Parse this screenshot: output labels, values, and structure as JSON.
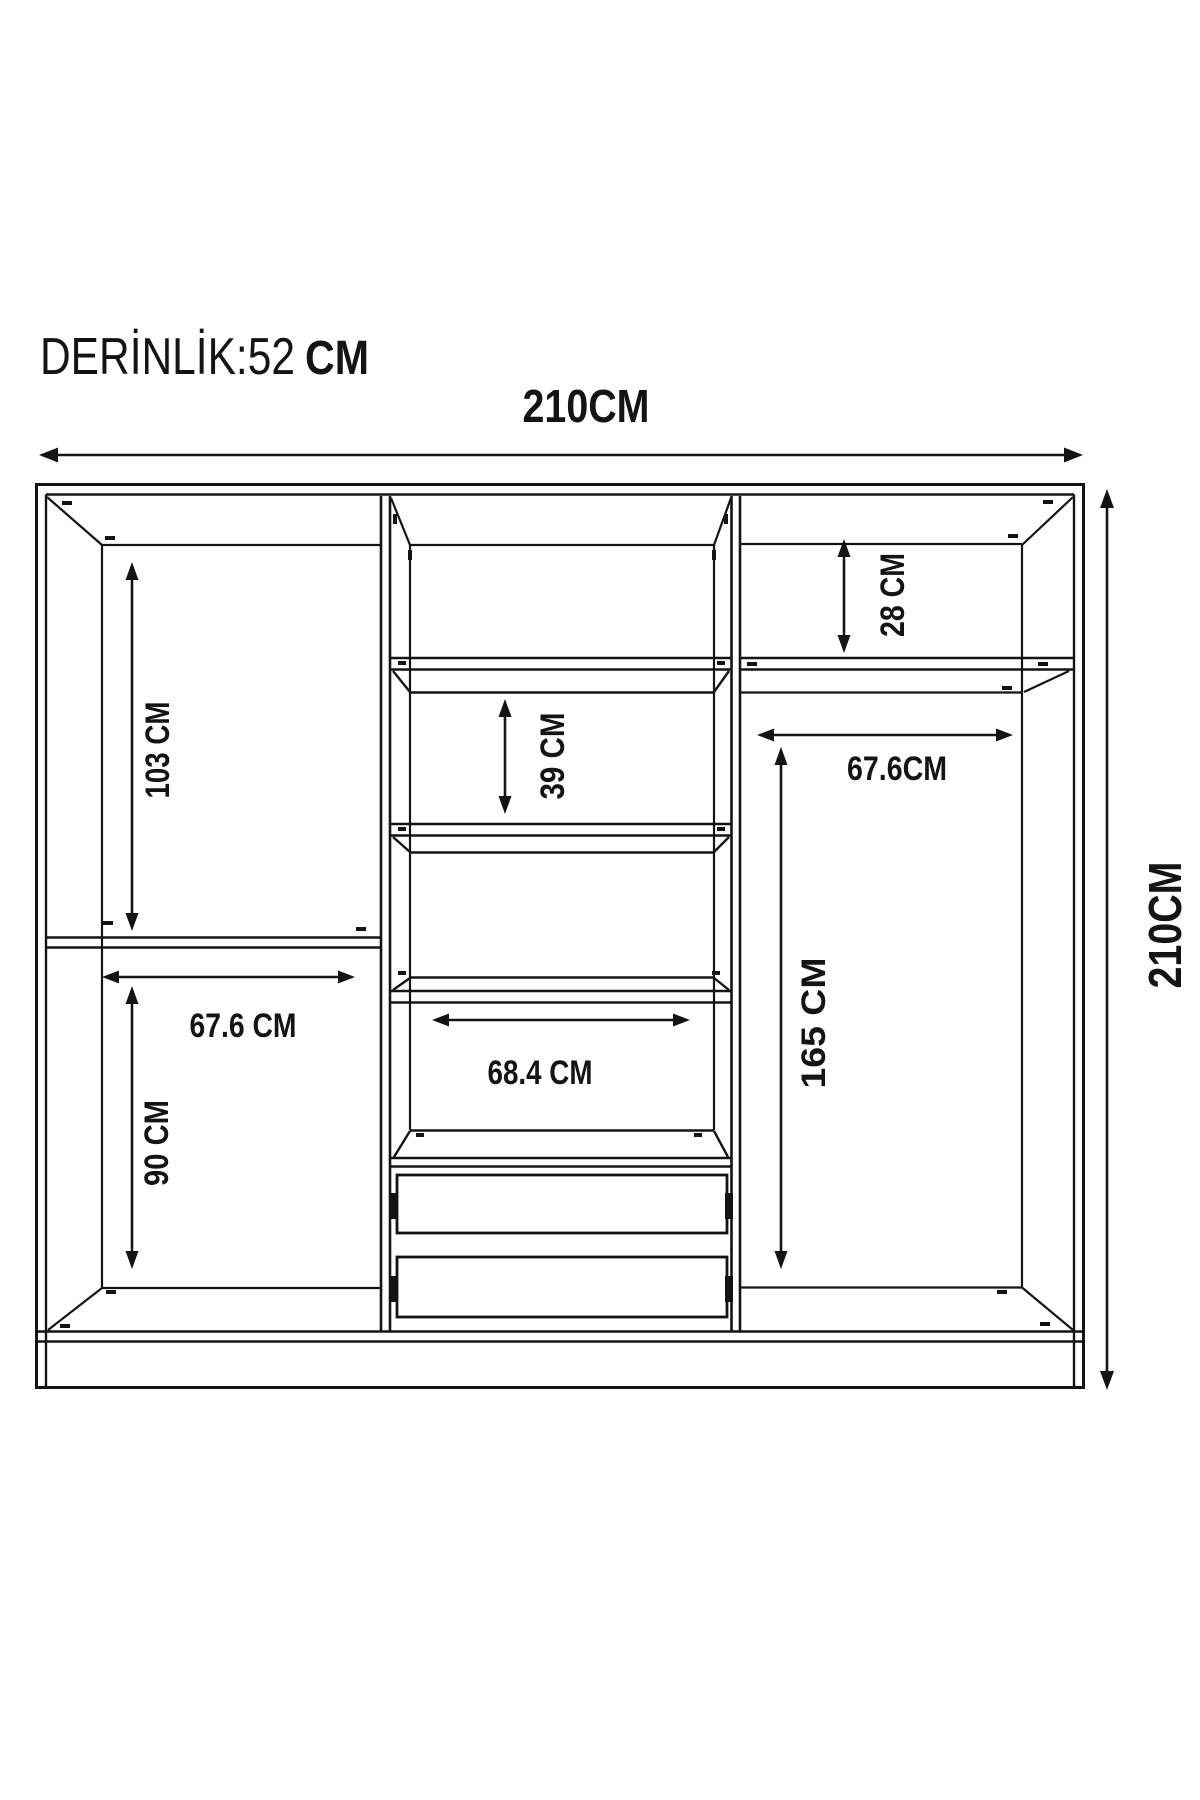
{
  "title": {
    "text": "DERİNLİK:52",
    "unit": "CM"
  },
  "labels": {
    "width_top": "210CM",
    "height_right": "210CM",
    "left_upper_height": "103 CM",
    "left_shelf_width": "67.6 CM",
    "left_lower_height": "90 CM",
    "middle_compartment_height": "39 CM",
    "middle_shelf_width": "68.4 CM",
    "right_top_height": "28 CM",
    "right_shelf_width": "67.6CM",
    "right_hanging_height": "165 CM"
  },
  "colors": {
    "line": "#141414",
    "background": "#ffffff"
  }
}
